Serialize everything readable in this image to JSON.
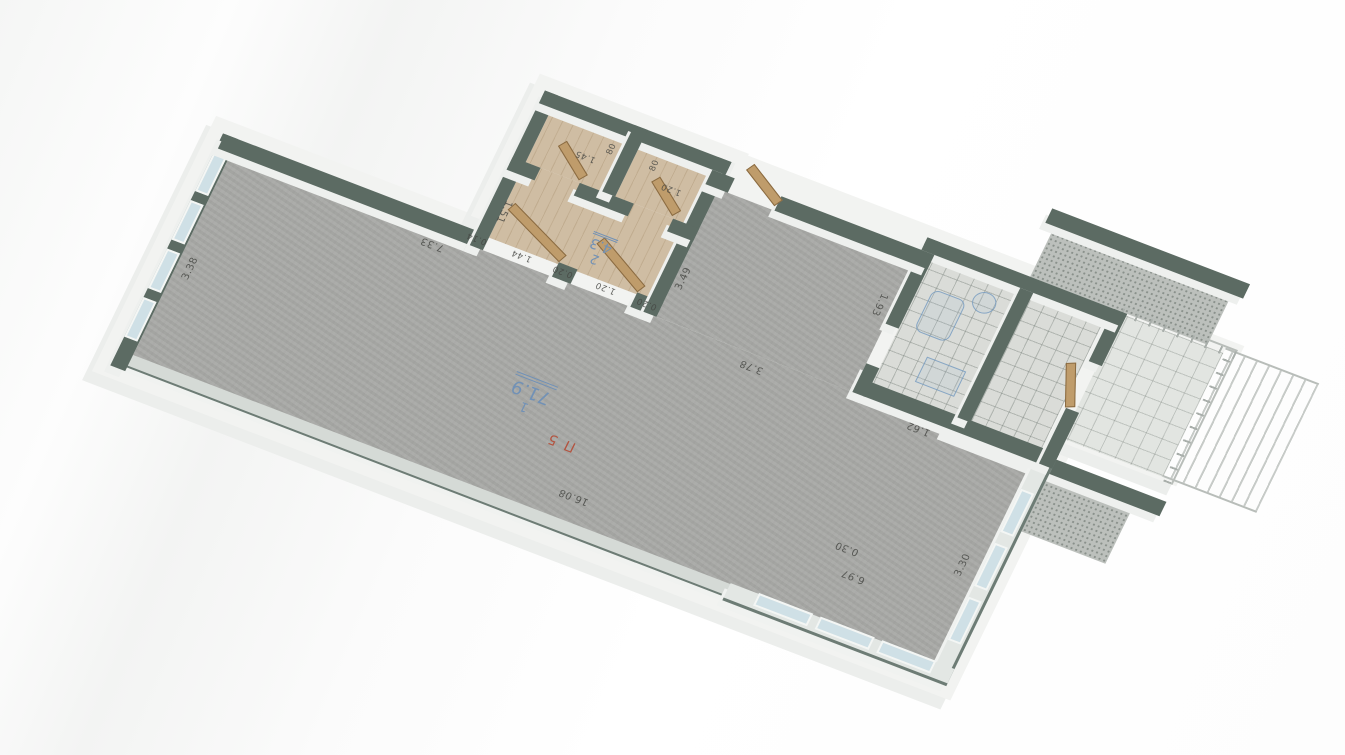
{
  "plan": {
    "unit_label": "П 5",
    "rooms": [
      {
        "number": "1",
        "area": "71.9"
      },
      {
        "number": "2",
        "area": "4.3"
      }
    ],
    "dimensions": {
      "big_room_length": "16.08",
      "big_room_left_width": "3.38",
      "top_wall": "7.33",
      "upper_edge": "3.78",
      "hall_side": "3.49",
      "right_width": "6.97",
      "offset": "0.30",
      "end_windows": "3.30",
      "bath_a": "1.93",
      "bath_b": "1.62",
      "hall_edge": "1.51",
      "door_row": [
        "0.20",
        "1.20",
        "0.20",
        "1.44",
        "0.14"
      ],
      "small_room_a_width": "1.45",
      "small_room_a_door": "80",
      "small_room_b_width": "1.20",
      "small_room_b_door": "80"
    },
    "colors": {
      "wall": "#5c6b63",
      "room_label": "#7191b6",
      "unit_label": "#b35440",
      "wood_floor": "#cfbda3",
      "concrete_floor": "#a8a9a6",
      "window_glass": "#cfe0e6"
    }
  }
}
